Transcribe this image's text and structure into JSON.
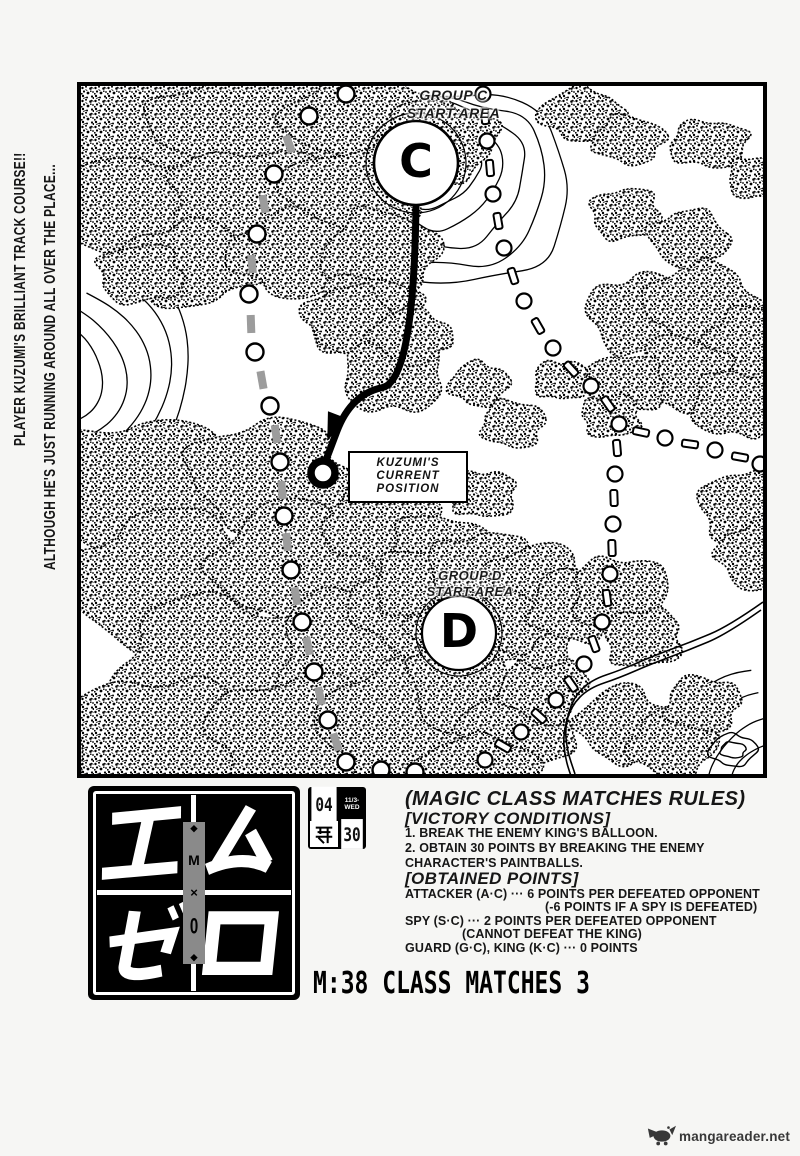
{
  "page": {
    "bg": "#f6f6f4",
    "ink": "#000000",
    "gray_dash": "#9c9c9c",
    "logo_gray": "#8a8a8a",
    "watermark_color": "#383838"
  },
  "margin_notes": {
    "line1": "PLAYER KUZUMI'S BRILLIANT TRACK COURSE!!",
    "line2": "ALTHOUGH HE'S JUST RUNNING AROUND ALL OVER THE PLACE..."
  },
  "map": {
    "group_c": {
      "line1": "GROUP C",
      "line2": "START AREA",
      "badge": "C"
    },
    "group_d": {
      "line1": "GROUP D",
      "line2": "START AREA",
      "badge": "D"
    },
    "position": {
      "line1": "KUZUMI'S",
      "line2": "CURRENT",
      "line3": "POSITION"
    }
  },
  "logo": {
    "katakana": [
      "エ",
      "ム",
      "ゼ",
      "ロ"
    ],
    "center_m": "M",
    "center_x": "×",
    "center_0": "0",
    "diamond": "◆"
  },
  "stamp": {
    "top_left": "04",
    "top_right_line1": "11/3-",
    "top_right_line2": "WED",
    "bottom_left": "第",
    "bottom_right": "30"
  },
  "rules": {
    "lines": [
      "(MAGIC CLASS MATCHES RULES)",
      "[VICTORY CONDITIONS]",
      "1.  BREAK THE ENEMY KING'S BALLOON.",
      "2. OBTAIN 30 POINTS BY BREAKING THE ENEMY",
      "CHARACTER'S PAINTBALLS.",
      "[OBTAINED POINTS]",
      "ATTACKER (A·C) ··· 6 POINTS PER DEFEATED OPPONENT",
      "(-6 POINTS IF A SPY IS DEFEATED)",
      "SPY (S·C) ··· 2 POINTS PER DEFEATED OPPONENT",
      "(CANNOT DEFEAT THE KING)",
      "GUARD (G·C), KING (K·C) ··· 0 POINTS"
    ]
  },
  "chapter_title": "M:38 CLASS MATCHES 3",
  "watermark": {
    "text": "mangareader.net"
  },
  "map_geometry": {
    "hill_contours": [
      [
        348,
        76,
        50,
        46,
        1
      ],
      [
        354,
        82,
        66,
        60,
        2
      ],
      [
        360,
        88,
        84,
        74,
        3
      ],
      [
        366,
        96,
        102,
        88,
        4
      ],
      [
        372,
        102,
        120,
        100,
        5
      ]
    ],
    "arcs_left": [
      [
        -28,
        290,
        50,
        -75,
        75,
        6
      ],
      [
        -28,
        290,
        72,
        -72,
        72,
        7
      ],
      [
        -28,
        290,
        94,
        -68,
        68,
        8
      ],
      [
        -28,
        290,
        116,
        -64,
        64,
        9
      ],
      [
        -28,
        290,
        138,
        -60,
        60,
        10
      ]
    ],
    "arcs_corner": [
      [
        690,
        696,
        38,
        176,
        266,
        11
      ],
      [
        690,
        696,
        62,
        176,
        264,
        12
      ],
      [
        690,
        696,
        86,
        177,
        262,
        13
      ],
      [
        690,
        696,
        110,
        178,
        260,
        14
      ]
    ],
    "pond": [
      [
        652,
        664,
        24,
        16,
        15
      ],
      [
        652,
        664,
        13,
        8,
        16
      ]
    ],
    "stream": [
      [
        682,
        516
      ],
      [
        648,
        540
      ],
      [
        610,
        556
      ],
      [
        572,
        570
      ],
      [
        540,
        584
      ],
      [
        510,
        594
      ],
      [
        492,
        612
      ],
      [
        484,
        640
      ],
      [
        486,
        664
      ],
      [
        494,
        688
      ]
    ],
    "forest": [
      [
        60,
        42,
        88,
        62
      ],
      [
        175,
        38,
        105,
        56
      ],
      [
        285,
        32,
        82,
        46
      ],
      [
        355,
        55,
        62,
        40
      ],
      [
        60,
        122,
        78,
        52
      ],
      [
        170,
        112,
        86,
        50
      ],
      [
        268,
        108,
        70,
        44
      ],
      [
        108,
        178,
        72,
        42
      ],
      [
        214,
        168,
        66,
        42
      ],
      [
        300,
        168,
        58,
        44
      ],
      [
        286,
        232,
        56,
        44
      ],
      [
        312,
        288,
        52,
        40
      ],
      [
        60,
        188,
        44,
        30
      ],
      [
        268,
        232,
        46,
        32
      ],
      [
        330,
        250,
        40,
        28
      ],
      [
        398,
        298,
        30,
        22
      ],
      [
        432,
        338,
        32,
        24
      ],
      [
        402,
        408,
        34,
        24
      ],
      [
        64,
        398,
        92,
        66
      ],
      [
        188,
        388,
        82,
        54
      ],
      [
        88,
        498,
        102,
        72
      ],
      [
        218,
        478,
        86,
        62
      ],
      [
        140,
        588,
        108,
        78
      ],
      [
        278,
        568,
        82,
        68
      ],
      [
        78,
        648,
        92,
        58
      ],
      [
        218,
        648,
        92,
        58
      ],
      [
        310,
        638,
        72,
        58
      ],
      [
        332,
        518,
        62,
        50
      ],
      [
        300,
        438,
        56,
        44
      ],
      [
        356,
        468,
        52,
        40
      ],
      [
        396,
        528,
        56,
        46
      ],
      [
        382,
        598,
        54,
        48
      ],
      [
        436,
        646,
        56,
        44
      ],
      [
        398,
        678,
        60,
        28
      ],
      [
        462,
        600,
        42,
        38
      ],
      [
        452,
        548,
        44,
        34
      ],
      [
        342,
        498,
        50,
        36
      ],
      [
        402,
        486,
        56,
        40
      ],
      [
        458,
        494,
        50,
        36
      ],
      [
        366,
        542,
        40,
        28
      ],
      [
        430,
        536,
        44,
        30
      ],
      [
        492,
        520,
        44,
        36
      ],
      [
        540,
        508,
        50,
        38
      ],
      [
        562,
        552,
        40,
        30
      ],
      [
        558,
        228,
        52,
        40
      ],
      [
        620,
        218,
        56,
        42
      ],
      [
        668,
        258,
        46,
        36
      ],
      [
        600,
        288,
        50,
        38
      ],
      [
        654,
        318,
        44,
        34
      ],
      [
        545,
        298,
        40,
        30
      ],
      [
        664,
        422,
        46,
        38
      ],
      [
        676,
        470,
        40,
        33
      ],
      [
        500,
        28,
        42,
        26
      ],
      [
        548,
        54,
        36,
        24
      ],
      [
        628,
        58,
        40,
        24
      ],
      [
        678,
        92,
        32,
        22
      ],
      [
        545,
        128,
        36,
        26
      ],
      [
        608,
        152,
        40,
        28
      ],
      [
        542,
        638,
        46,
        38
      ],
      [
        592,
        658,
        44,
        34
      ],
      [
        622,
        618,
        38,
        28
      ],
      [
        480,
        294,
        28,
        20
      ],
      [
        530,
        330,
        30,
        22
      ]
    ],
    "trail_left": [
      [
        "c",
        265,
        8
      ],
      [
        "c",
        228,
        30
      ],
      [
        "g",
        208,
        58,
        70
      ],
      [
        "c",
        193,
        88
      ],
      [
        "g",
        183,
        118,
        80
      ],
      [
        "c",
        176,
        148
      ],
      [
        "g",
        171,
        178,
        85
      ],
      [
        "c",
        168,
        208
      ],
      [
        "g",
        170,
        238,
        88
      ],
      [
        "c",
        174,
        266
      ],
      [
        "g",
        181,
        294,
        80
      ],
      [
        "c",
        189,
        320
      ],
      [
        "g",
        195,
        348,
        82
      ],
      [
        "c",
        199,
        376
      ],
      [
        "g",
        201,
        404,
        86
      ],
      [
        "c",
        203,
        430
      ],
      [
        "g",
        206,
        456,
        84
      ],
      [
        "c",
        210,
        484
      ],
      [
        "g",
        215,
        510,
        80
      ],
      [
        "c",
        221,
        536
      ],
      [
        "g",
        227,
        560,
        78
      ],
      [
        "c",
        233,
        586
      ],
      [
        "g",
        239,
        610,
        78
      ],
      [
        "c",
        247,
        634
      ],
      [
        "g",
        255,
        656,
        72
      ],
      [
        "c",
        265,
        676
      ],
      [
        "c",
        300,
        684
      ],
      [
        "c",
        334,
        686
      ]
    ],
    "trail_right": [
      [
        "c",
        402,
        8
      ],
      [
        "d",
        404,
        30,
        85
      ],
      [
        "c",
        406,
        55
      ],
      [
        "d",
        409,
        82,
        85
      ],
      [
        "c",
        412,
        108
      ],
      [
        "d",
        417,
        135,
        80
      ],
      [
        "c",
        423,
        162
      ],
      [
        "d",
        432,
        190,
        72
      ],
      [
        "c",
        443,
        215
      ],
      [
        "d",
        457,
        240,
        60
      ],
      [
        "c",
        472,
        262
      ],
      [
        "d",
        490,
        283,
        48
      ],
      [
        "c",
        510,
        300
      ],
      [
        "d",
        527,
        318,
        55
      ],
      [
        "c",
        538,
        338
      ],
      [
        "d",
        560,
        346,
        12
      ],
      [
        "c",
        584,
        352
      ],
      [
        "d",
        609,
        358,
        8
      ],
      [
        "c",
        634,
        364
      ],
      [
        "d",
        659,
        371,
        10
      ],
      [
        "c",
        679,
        378
      ],
      [
        "d",
        536,
        362,
        85
      ],
      [
        "c",
        534,
        388
      ],
      [
        "d",
        533,
        412,
        88
      ],
      [
        "c",
        532,
        438
      ],
      [
        "d",
        531,
        462,
        88
      ],
      [
        "c",
        529,
        488
      ],
      [
        "d",
        526,
        512,
        82
      ],
      [
        "c",
        521,
        536
      ],
      [
        "d",
        513,
        558,
        70
      ],
      [
        "c",
        503,
        578
      ],
      [
        "d",
        490,
        598,
        55
      ],
      [
        "c",
        475,
        614
      ],
      [
        "d",
        458,
        630,
        42
      ],
      [
        "c",
        440,
        646
      ],
      [
        "d",
        422,
        660,
        30
      ],
      [
        "c",
        404,
        674
      ]
    ],
    "route": [
      [
        335,
        118
      ],
      [
        333,
        295
      ],
      [
        270,
        308
      ],
      [
        242,
        382
      ]
    ],
    "arrow": {
      "x": 252,
      "y": 340,
      "angle": 111
    },
    "ring": [
      242,
      387
    ],
    "c_badge": [
      335,
      77
    ],
    "d_badge": [
      378,
      547
    ]
  }
}
